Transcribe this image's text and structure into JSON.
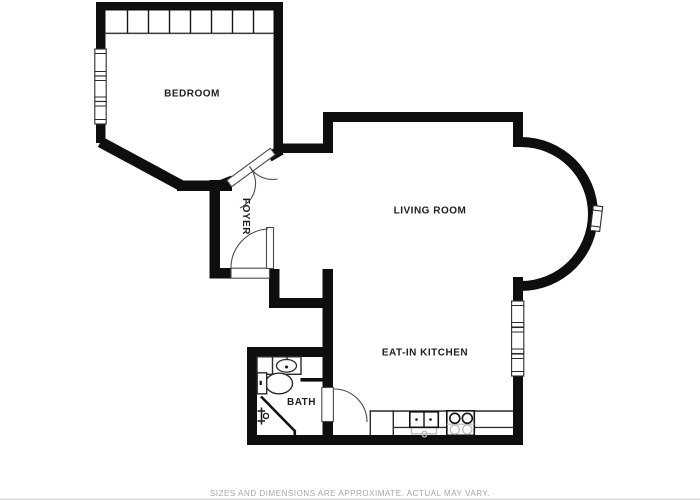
{
  "floor_plan": {
    "title": "apartment-floor-plan",
    "rooms": [
      {
        "id": "bedroom",
        "label": "BEDROOM"
      },
      {
        "id": "foyer",
        "label": "FOYER"
      },
      {
        "id": "living",
        "label": "LIVING ROOM"
      },
      {
        "id": "kitchen",
        "label": "EAT-IN KITCHEN"
      },
      {
        "id": "bath",
        "label": "BATH"
      }
    ],
    "disclaimer": "SIZES AND DIMENSIONS ARE APPROXIMATE. ACTUAL MAY VARY.",
    "symbols": {
      "windows": [
        "bedroom-window-1",
        "bedroom-window-2",
        "bedroom-window-3",
        "kitchen-window-1",
        "kitchen-window-2",
        "kitchen-window-3",
        "bay-window"
      ],
      "doors": [
        "entry-door",
        "bedroom-double-doors",
        "bath-door"
      ],
      "fixtures": [
        "closet",
        "bath-vanity-sink",
        "toilet",
        "shower",
        "kitchen-sink",
        "stove"
      ]
    },
    "colors": {
      "background": "#ffffff",
      "wall": "#0e0e0e",
      "outline": "#2b2b2b",
      "door_arc": "#4a4a4a",
      "light_gray": "#b9b9b9",
      "label": "#1f1f1f",
      "disclaimer": "#a6a6a6",
      "page_edge": "#dcdcdc"
    }
  }
}
